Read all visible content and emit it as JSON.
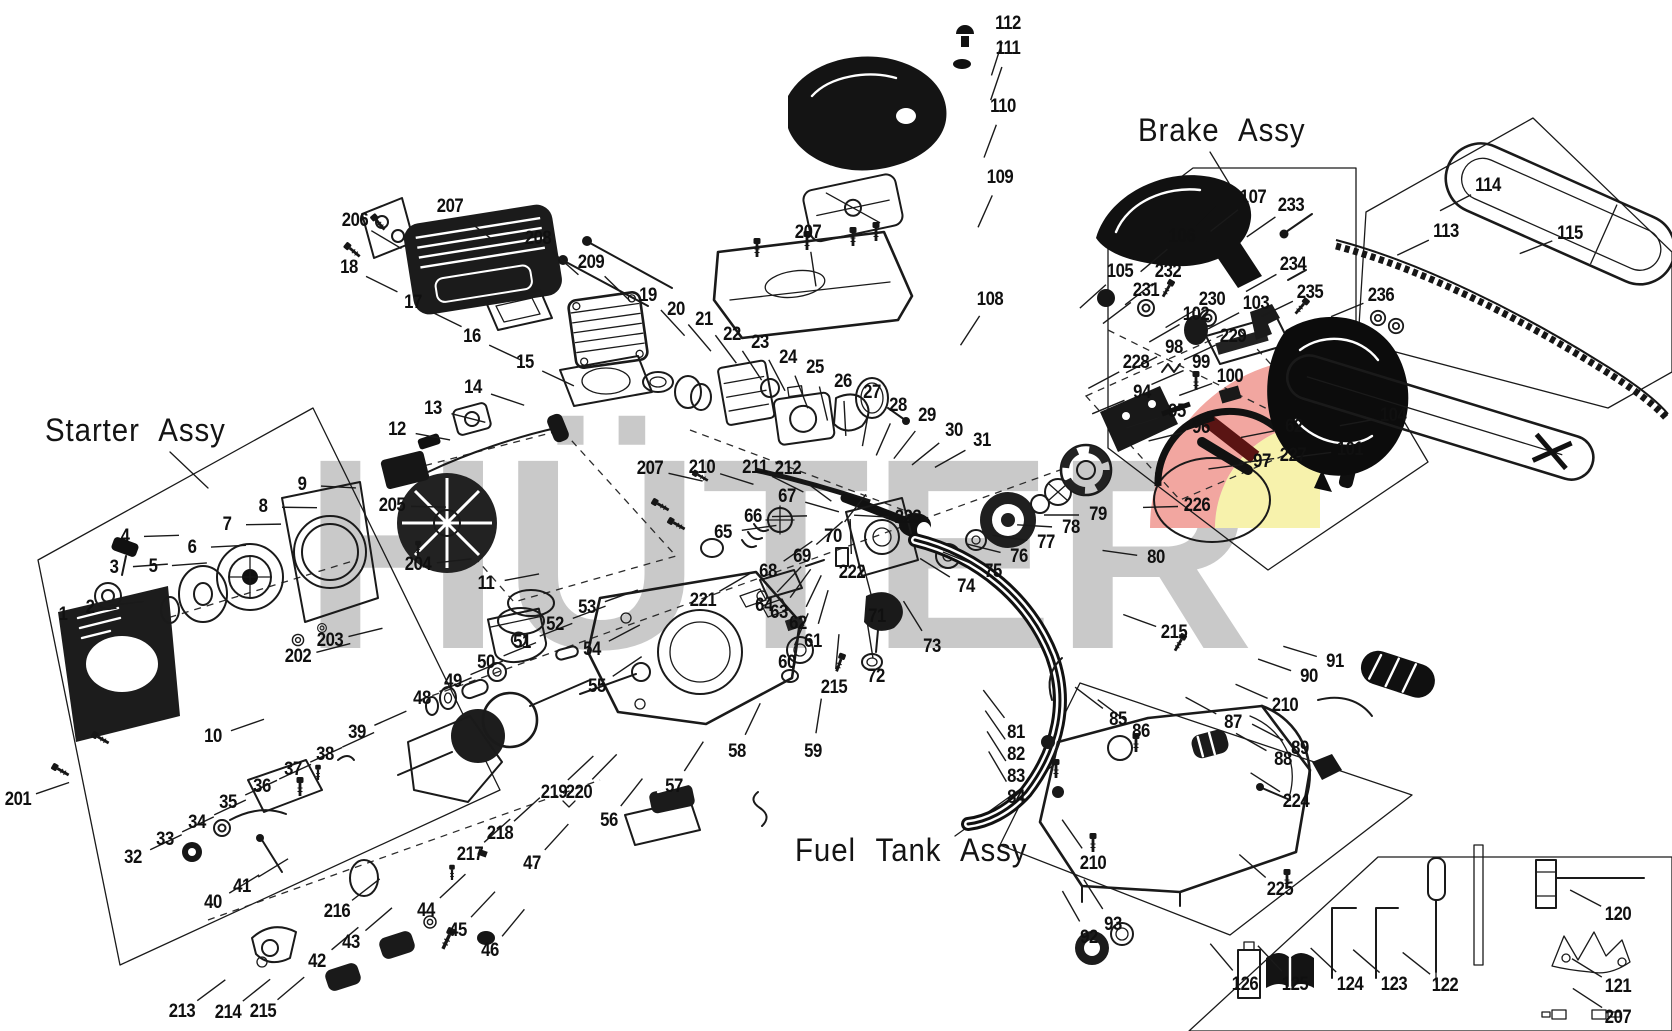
{
  "doc": {
    "brand_watermark": "HÜTER",
    "colors": {
      "line": "#1a1a1a",
      "watermark_gray": "#c9c9c9",
      "logo_pink": "#f2a6a0",
      "logo_yellow": "#f7f2ac",
      "logo_stripe": "#5a1413"
    },
    "assembly_labels": [
      {
        "id": "starter",
        "label": "Starter Assy"
      },
      {
        "id": "brake",
        "label": "Brake Assy"
      },
      {
        "id": "fuel",
        "label": "Fuel Tank Assy"
      }
    ],
    "callouts": [
      {
        "n": "1",
        "x": 63,
        "y": 615
      },
      {
        "n": "2",
        "x": 90,
        "y": 608
      },
      {
        "n": "3",
        "x": 114,
        "y": 568
      },
      {
        "n": "4",
        "x": 125,
        "y": 537
      },
      {
        "n": "5",
        "x": 153,
        "y": 567
      },
      {
        "n": "6",
        "x": 192,
        "y": 548
      },
      {
        "n": "7",
        "x": 227,
        "y": 525
      },
      {
        "n": "8",
        "x": 263,
        "y": 507
      },
      {
        "n": "9",
        "x": 302,
        "y": 485
      },
      {
        "n": "10",
        "x": 213,
        "y": 737
      },
      {
        "n": "11",
        "x": 486,
        "y": 584
      },
      {
        "n": "12",
        "x": 397,
        "y": 430
      },
      {
        "n": "13",
        "x": 433,
        "y": 409
      },
      {
        "n": "14",
        "x": 473,
        "y": 388
      },
      {
        "n": "15",
        "x": 525,
        "y": 363
      },
      {
        "n": "16",
        "x": 472,
        "y": 337
      },
      {
        "n": "17",
        "x": 413,
        "y": 303
      },
      {
        "n": "18",
        "x": 349,
        "y": 268
      },
      {
        "n": "19",
        "x": 648,
        "y": 296
      },
      {
        "n": "20",
        "x": 676,
        "y": 310
      },
      {
        "n": "21",
        "x": 704,
        "y": 320
      },
      {
        "n": "22",
        "x": 732,
        "y": 335
      },
      {
        "n": "23",
        "x": 760,
        "y": 343
      },
      {
        "n": "24",
        "x": 788,
        "y": 358
      },
      {
        "n": "25",
        "x": 815,
        "y": 368
      },
      {
        "n": "26",
        "x": 843,
        "y": 382
      },
      {
        "n": "27",
        "x": 872,
        "y": 393
      },
      {
        "n": "28",
        "x": 898,
        "y": 406
      },
      {
        "n": "29",
        "x": 927,
        "y": 416
      },
      {
        "n": "30",
        "x": 954,
        "y": 431
      },
      {
        "n": "31",
        "x": 982,
        "y": 441
      },
      {
        "n": "32",
        "x": 133,
        "y": 858
      },
      {
        "n": "33",
        "x": 165,
        "y": 840
      },
      {
        "n": "34",
        "x": 197,
        "y": 823
      },
      {
        "n": "35",
        "x": 228,
        "y": 803
      },
      {
        "n": "36",
        "x": 262,
        "y": 787
      },
      {
        "n": "37",
        "x": 293,
        "y": 770
      },
      {
        "n": "38",
        "x": 325,
        "y": 755
      },
      {
        "n": "39",
        "x": 357,
        "y": 733
      },
      {
        "n": "40",
        "x": 213,
        "y": 903
      },
      {
        "n": "41",
        "x": 242,
        "y": 887
      },
      {
        "n": "42",
        "x": 317,
        "y": 962
      },
      {
        "n": "43",
        "x": 351,
        "y": 943
      },
      {
        "n": "44",
        "x": 426,
        "y": 911
      },
      {
        "n": "45",
        "x": 458,
        "y": 931
      },
      {
        "n": "46",
        "x": 490,
        "y": 951
      },
      {
        "n": "47",
        "x": 532,
        "y": 864
      },
      {
        "n": "48",
        "x": 422,
        "y": 699
      },
      {
        "n": "49",
        "x": 453,
        "y": 682
      },
      {
        "n": "50",
        "x": 486,
        "y": 663
      },
      {
        "n": "51",
        "x": 522,
        "y": 643
      },
      {
        "n": "52",
        "x": 555,
        "y": 625
      },
      {
        "n": "53",
        "x": 587,
        "y": 608
      },
      {
        "n": "54",
        "x": 592,
        "y": 650
      },
      {
        "n": "55",
        "x": 597,
        "y": 687
      },
      {
        "n": "56",
        "x": 609,
        "y": 821
      },
      {
        "n": "57",
        "x": 674,
        "y": 787
      },
      {
        "n": "58",
        "x": 737,
        "y": 752
      },
      {
        "n": "59",
        "x": 813,
        "y": 752
      },
      {
        "n": "60",
        "x": 787,
        "y": 663
      },
      {
        "n": "61",
        "x": 813,
        "y": 642
      },
      {
        "n": "62",
        "x": 798,
        "y": 624
      },
      {
        "n": "63",
        "x": 779,
        "y": 613
      },
      {
        "n": "64",
        "x": 764,
        "y": 606
      },
      {
        "n": "65",
        "x": 723,
        "y": 533
      },
      {
        "n": "66",
        "x": 753,
        "y": 517
      },
      {
        "n": "67",
        "x": 787,
        "y": 497
      },
      {
        "n": "68",
        "x": 768,
        "y": 572
      },
      {
        "n": "69",
        "x": 802,
        "y": 557
      },
      {
        "n": "70",
        "x": 833,
        "y": 537
      },
      {
        "n": "71",
        "x": 877,
        "y": 617
      },
      {
        "n": "72",
        "x": 876,
        "y": 677
      },
      {
        "n": "73",
        "x": 932,
        "y": 647
      },
      {
        "n": "74",
        "x": 966,
        "y": 587
      },
      {
        "n": "75",
        "x": 993,
        "y": 572
      },
      {
        "n": "76",
        "x": 1019,
        "y": 557
      },
      {
        "n": "77",
        "x": 1046,
        "y": 543
      },
      {
        "n": "78",
        "x": 1071,
        "y": 528
      },
      {
        "n": "79",
        "x": 1098,
        "y": 515
      },
      {
        "n": "80",
        "x": 1156,
        "y": 558
      },
      {
        "n": "81",
        "x": 1016,
        "y": 733
      },
      {
        "n": "82",
        "x": 1016,
        "y": 755
      },
      {
        "n": "83",
        "x": 1016,
        "y": 777
      },
      {
        "n": "84",
        "x": 1016,
        "y": 798
      },
      {
        "n": "85",
        "x": 1118,
        "y": 720
      },
      {
        "n": "86",
        "x": 1141,
        "y": 732
      },
      {
        "n": "87",
        "x": 1233,
        "y": 723
      },
      {
        "n": "88",
        "x": 1283,
        "y": 760
      },
      {
        "n": "89",
        "x": 1300,
        "y": 749
      },
      {
        "n": "90",
        "x": 1309,
        "y": 677
      },
      {
        "n": "91",
        "x": 1335,
        "y": 662
      },
      {
        "n": "92",
        "x": 1089,
        "y": 938
      },
      {
        "n": "93",
        "x": 1113,
        "y": 925
      },
      {
        "n": "94",
        "x": 1142,
        "y": 393
      },
      {
        "n": "95",
        "x": 1177,
        "y": 412
      },
      {
        "n": "96",
        "x": 1201,
        "y": 428
      },
      {
        "n": "97",
        "x": 1262,
        "y": 462
      },
      {
        "n": "98",
        "x": 1174,
        "y": 348
      },
      {
        "n": "99",
        "x": 1201,
        "y": 363
      },
      {
        "n": "100",
        "x": 1230,
        "y": 377
      },
      {
        "n": "101",
        "x": 1350,
        "y": 450
      },
      {
        "n": "102",
        "x": 1196,
        "y": 315
      },
      {
        "n": "103",
        "x": 1256,
        "y": 304
      },
      {
        "n": "104",
        "x": 1393,
        "y": 416
      },
      {
        "n": "105",
        "x": 1120,
        "y": 272
      },
      {
        "n": "106",
        "x": 1182,
        "y": 237
      },
      {
        "n": "107",
        "x": 1253,
        "y": 198
      },
      {
        "n": "108",
        "x": 990,
        "y": 300
      },
      {
        "n": "109",
        "x": 1000,
        "y": 178
      },
      {
        "n": "110",
        "x": 1003,
        "y": 107
      },
      {
        "n": "111",
        "x": 1008,
        "y": 49
      },
      {
        "n": "112",
        "x": 1008,
        "y": 24
      },
      {
        "n": "113",
        "x": 1446,
        "y": 232
      },
      {
        "n": "114",
        "x": 1488,
        "y": 186
      },
      {
        "n": "115",
        "x": 1570,
        "y": 234
      },
      {
        "n": "120",
        "x": 1618,
        "y": 915
      },
      {
        "n": "121",
        "x": 1618,
        "y": 987
      },
      {
        "n": "122",
        "x": 1445,
        "y": 986
      },
      {
        "n": "123",
        "x": 1394,
        "y": 985
      },
      {
        "n": "124",
        "x": 1350,
        "y": 985
      },
      {
        "n": "125",
        "x": 1295,
        "y": 985
      },
      {
        "n": "126",
        "x": 1245,
        "y": 985
      },
      {
        "n": "62",
        "x": 1294,
        "y": 427
      },
      {
        "n": "201",
        "x": 18,
        "y": 800
      },
      {
        "n": "202",
        "x": 298,
        "y": 657
      },
      {
        "n": "203",
        "x": 330,
        "y": 641
      },
      {
        "n": "204",
        "x": 418,
        "y": 565
      },
      {
        "n": "205",
        "x": 392,
        "y": 506
      },
      {
        "n": "206",
        "x": 355,
        "y": 221
      },
      {
        "n": "207",
        "x": 450,
        "y": 207
      },
      {
        "n": "207",
        "x": 808,
        "y": 233
      },
      {
        "n": "207",
        "x": 650,
        "y": 469
      },
      {
        "n": "207",
        "x": 1618,
        "y": 1018
      },
      {
        "n": "208",
        "x": 538,
        "y": 239
      },
      {
        "n": "209",
        "x": 591,
        "y": 263
      },
      {
        "n": "210",
        "x": 702,
        "y": 468
      },
      {
        "n": "210",
        "x": 1093,
        "y": 864
      },
      {
        "n": "210",
        "x": 1285,
        "y": 706
      },
      {
        "n": "211",
        "x": 755,
        "y": 468
      },
      {
        "n": "212",
        "x": 788,
        "y": 469
      },
      {
        "n": "213",
        "x": 182,
        "y": 1012
      },
      {
        "n": "214",
        "x": 228,
        "y": 1013
      },
      {
        "n": "215",
        "x": 263,
        "y": 1012
      },
      {
        "n": "215",
        "x": 834,
        "y": 688
      },
      {
        "n": "215",
        "x": 1174,
        "y": 633
      },
      {
        "n": "216",
        "x": 337,
        "y": 912
      },
      {
        "n": "217",
        "x": 470,
        "y": 855
      },
      {
        "n": "218",
        "x": 500,
        "y": 834
      },
      {
        "n": "219",
        "x": 554,
        "y": 793
      },
      {
        "n": "220",
        "x": 579,
        "y": 793
      },
      {
        "n": "221",
        "x": 703,
        "y": 601
      },
      {
        "n": "222",
        "x": 852,
        "y": 573
      },
      {
        "n": "223",
        "x": 908,
        "y": 518
      },
      {
        "n": "224",
        "x": 1296,
        "y": 802
      },
      {
        "n": "225",
        "x": 1280,
        "y": 890
      },
      {
        "n": "226",
        "x": 1197,
        "y": 506
      },
      {
        "n": "227",
        "x": 1293,
        "y": 456
      },
      {
        "n": "228",
        "x": 1136,
        "y": 363
      },
      {
        "n": "229",
        "x": 1233,
        "y": 337
      },
      {
        "n": "230",
        "x": 1212,
        "y": 300
      },
      {
        "n": "231",
        "x": 1146,
        "y": 291
      },
      {
        "n": "232",
        "x": 1168,
        "y": 272
      },
      {
        "n": "233",
        "x": 1291,
        "y": 206
      },
      {
        "n": "234",
        "x": 1293,
        "y": 265
      },
      {
        "n": "235",
        "x": 1310,
        "y": 293
      },
      {
        "n": "236",
        "x": 1381,
        "y": 296
      }
    ]
  }
}
